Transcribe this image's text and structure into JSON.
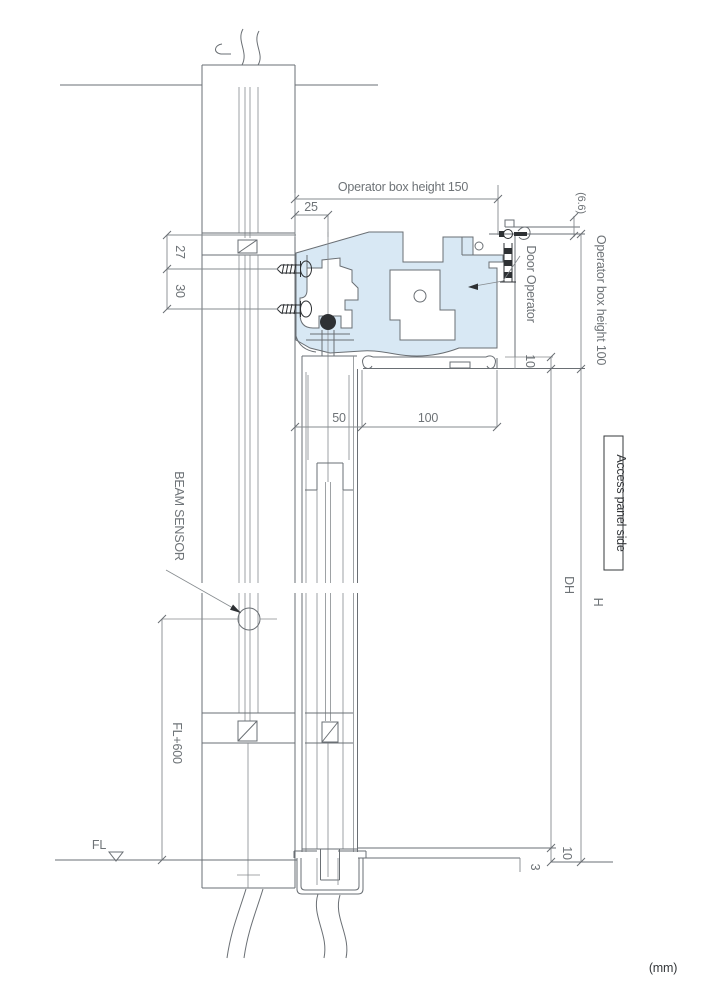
{
  "drawing": {
    "unit_label": "(mm)",
    "labels": {
      "door_operator": "Door Operator",
      "beam_sensor": "BEAM SENSOR",
      "access_panel_side": "Access panel side",
      "floor_level": "FL",
      "beam_height": "FL+600",
      "door_height": "DH",
      "overall_height": "H"
    },
    "dimensions": {
      "operator_box_height_150": "Operator box height 150",
      "operator_box_height_100": "Operator box height 100",
      "offset_25": "25",
      "offset_27": "27",
      "offset_30": "30",
      "depth_50": "50",
      "depth_100": "100",
      "gap_10_top": "10",
      "gap_10_bottom": "10",
      "gap_3": "3",
      "gap_6_6": "(6.6)"
    },
    "colors": {
      "operator_box_fill": "#d8e8f4",
      "line": "#6a6f74",
      "dim_text": "#6e7377",
      "dark_text": "#35383b"
    }
  }
}
